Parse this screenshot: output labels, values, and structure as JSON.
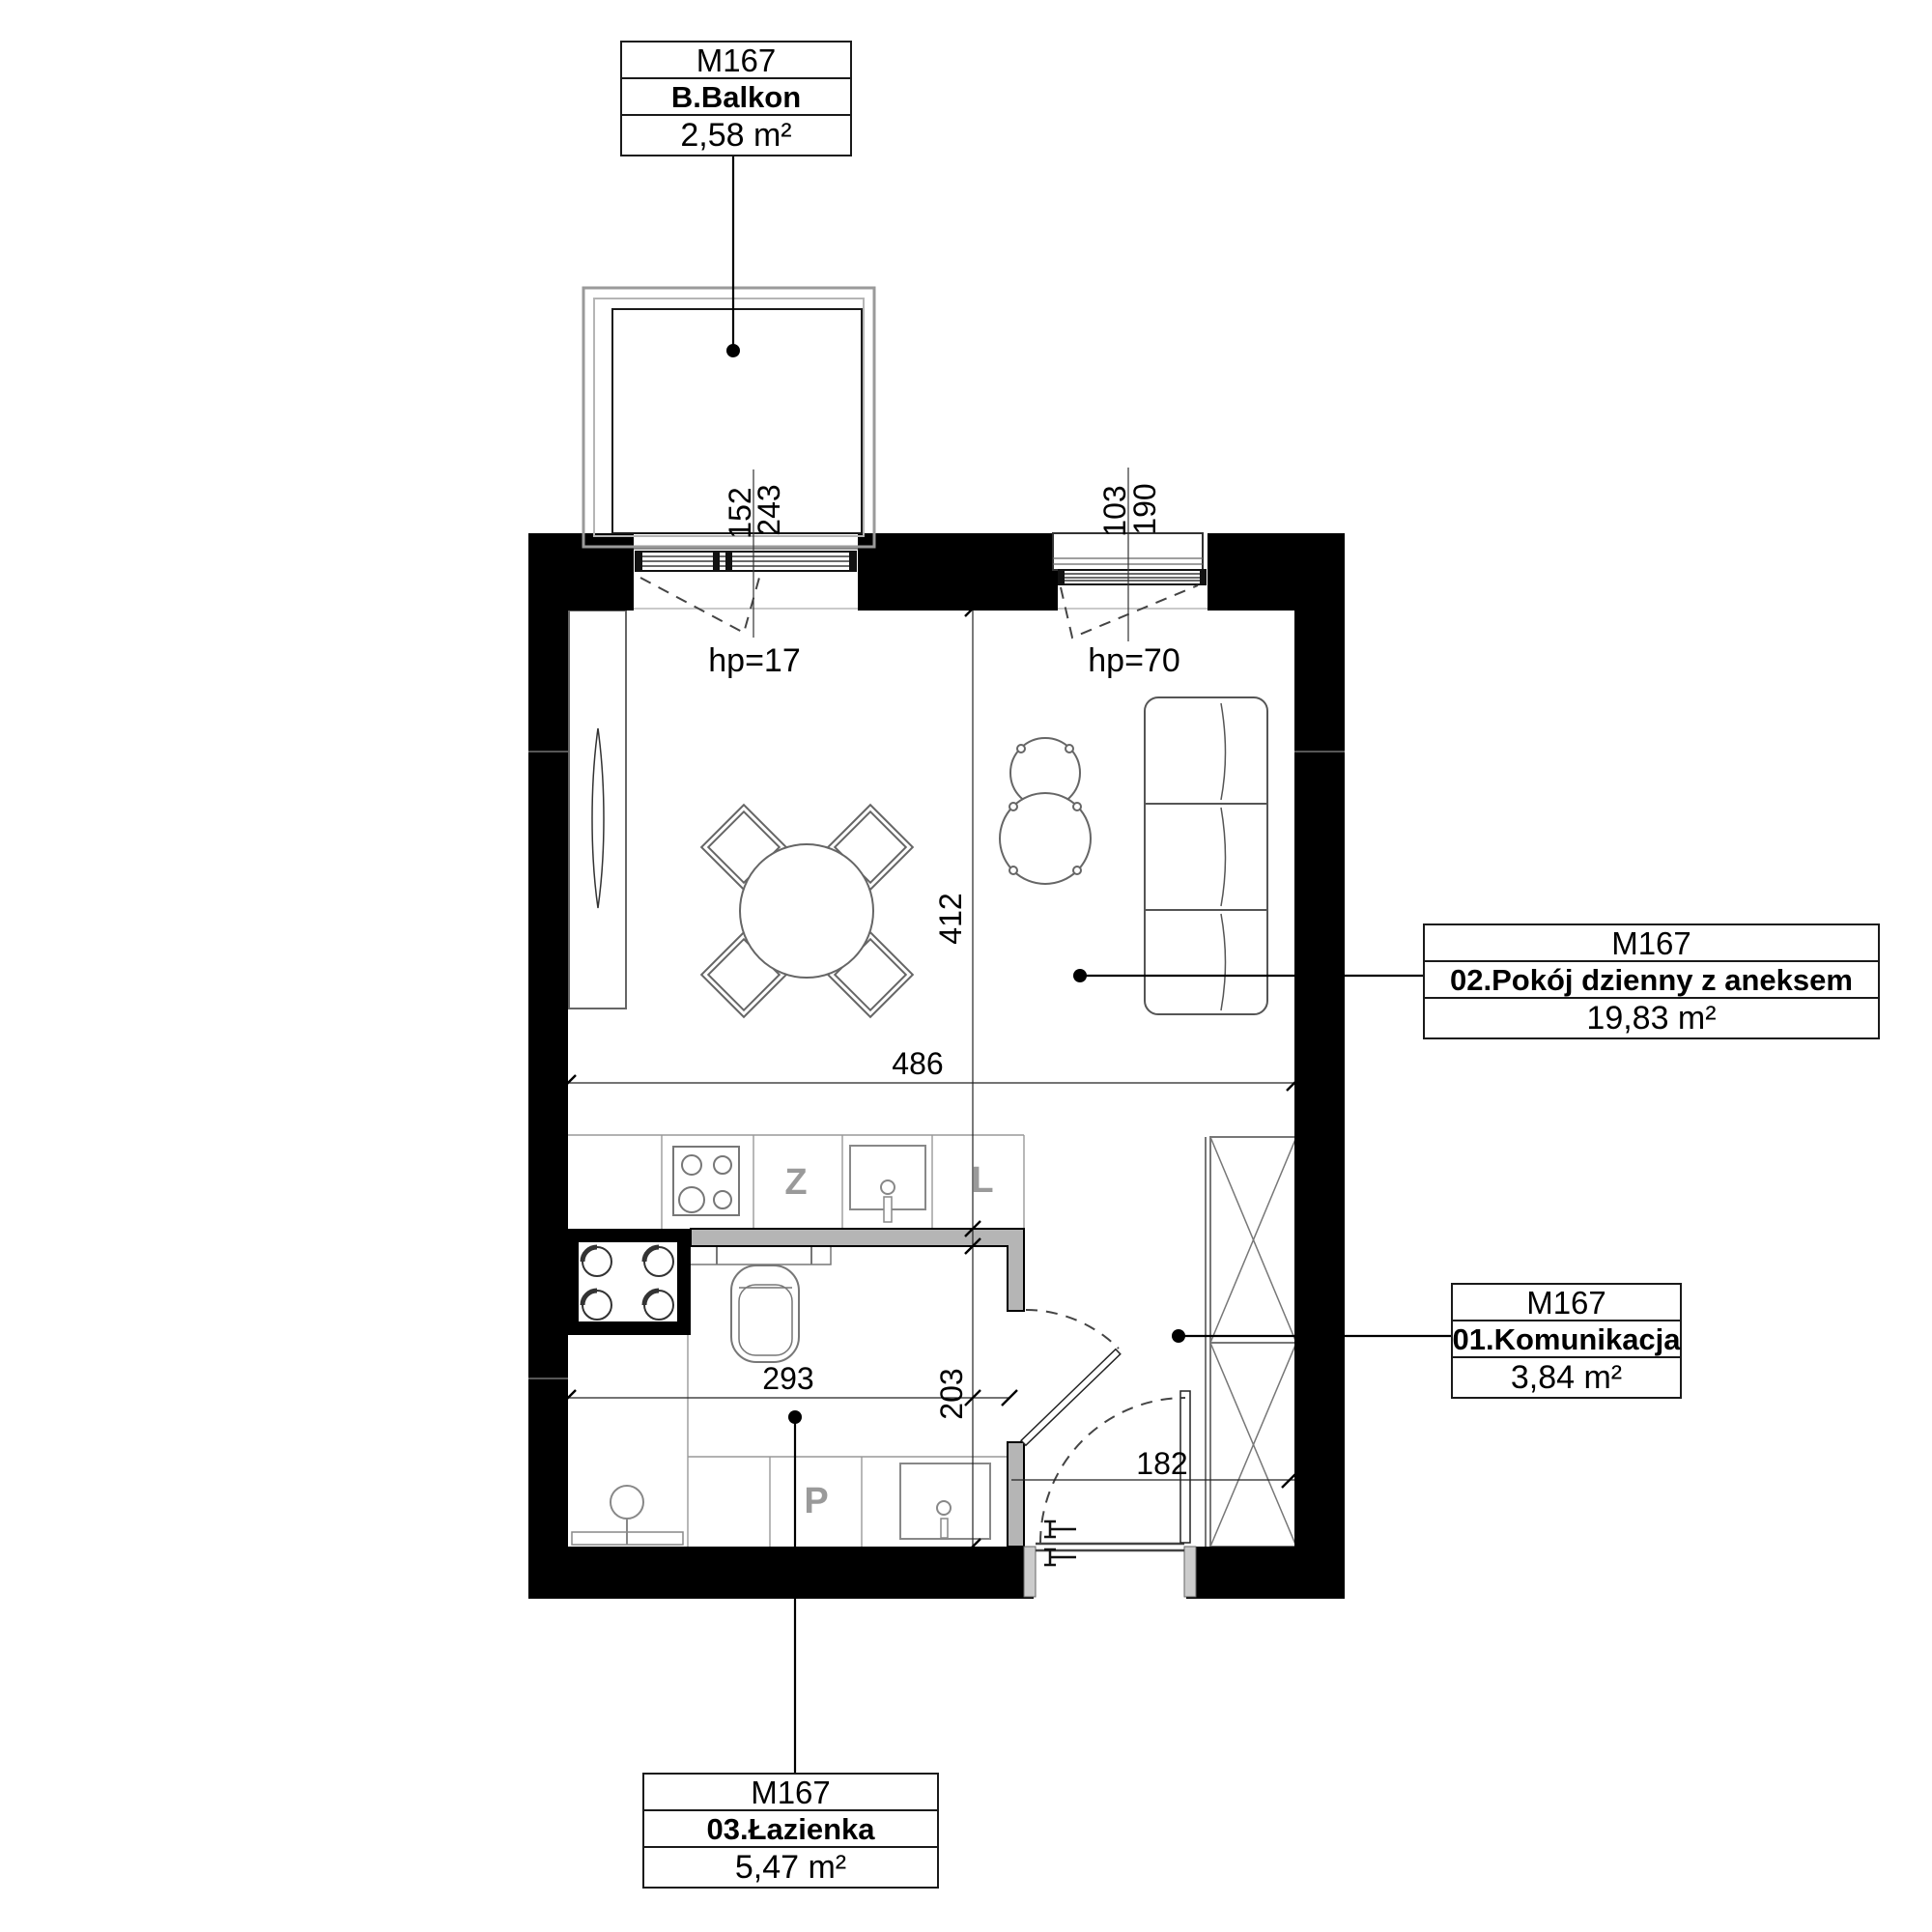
{
  "plan_title": "M167 apartment floor plan",
  "labels": {
    "balcony": {
      "code": "M167",
      "name": "B.Balkon",
      "area": "2,58 m²"
    },
    "living": {
      "code": "M167",
      "name": "02.Pokój dzienny z aneksem",
      "area": "19,83 m²"
    },
    "hall": {
      "code": "M167",
      "name": "01.Komunikacja",
      "area": "3,84 m²"
    },
    "bath": {
      "code": "M167",
      "name": "03.Łazienka",
      "area": "5,47 m²"
    }
  },
  "dimensions_cm": {
    "balcony_window_width": "152",
    "balcony_window_total": "243",
    "window_width": "103",
    "window_total": "190",
    "balcony_window_sill": "hp=17",
    "window_sill": "hp=70",
    "living_depth": "412",
    "living_width": "486",
    "bath_width": "293",
    "bath_depth": "203",
    "hall_width": "182"
  },
  "appliances": {
    "dishwasher": "Z",
    "fridge": "L",
    "washer": "P"
  },
  "colors": {
    "background": "#ffffff",
    "exterior_wall": "#000000",
    "interior_partition": "#b5b5b5",
    "furniture_line": "#666666",
    "appliance_letter": "#9a9a9a"
  }
}
